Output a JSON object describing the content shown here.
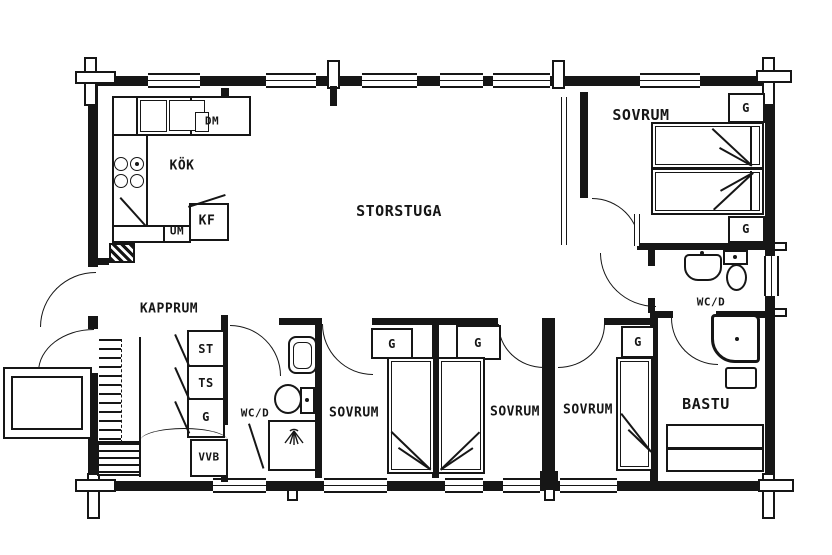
{
  "rooms": {
    "kitchen": {
      "label": "KÖK"
    },
    "living_room": {
      "label": "STORSTUGA"
    },
    "bedroom_ne": {
      "label": "SOVRUM"
    },
    "wc_ne": {
      "label": "WC/D"
    },
    "hallway": {
      "label": "KAPPRUM"
    },
    "wc_sw": {
      "label": "WC/D"
    },
    "bedroom_s1": {
      "label": "SOVRUM"
    },
    "bedroom_s2": {
      "label": "SOVRUM"
    },
    "bedroom_s3": {
      "label": "SOVRUM"
    },
    "sauna": {
      "label": "BASTU"
    }
  },
  "cabinets": {
    "dishwasher": "DM",
    "oven": "UM",
    "fridge_freezer": "KF",
    "cleaning_closet": "ST",
    "drying_closet": "TS",
    "wardrobe": "G",
    "water_heater": "VVB"
  }
}
